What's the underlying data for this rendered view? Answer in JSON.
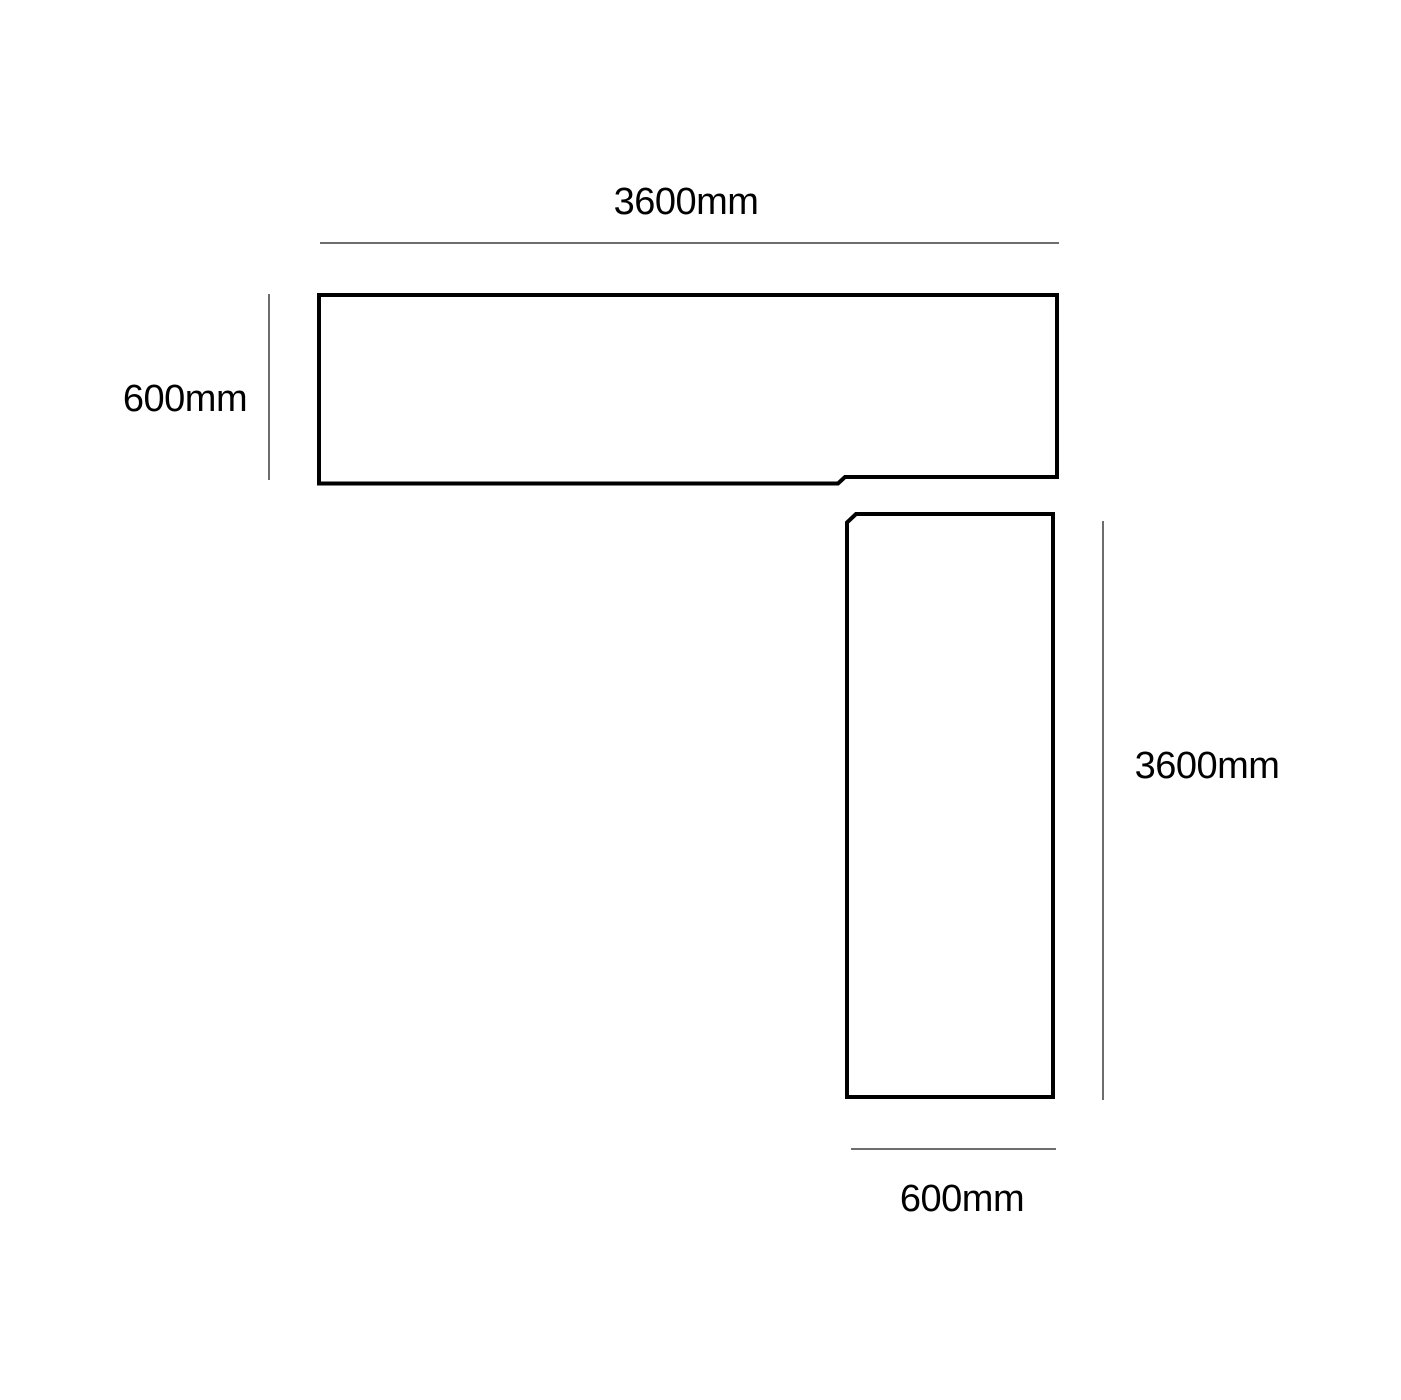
{
  "diagram": {
    "kind": "l-shape-worktop-dimension-drawing",
    "dimensions": {
      "top_length": "3600mm",
      "left_width": "600mm",
      "right_length": "3600mm",
      "bottom_width": "600mm"
    },
    "colors": {
      "outline": "#000000",
      "dimension_line": "#3d3d3d",
      "text": "#000000",
      "background": "#ffffff"
    }
  }
}
